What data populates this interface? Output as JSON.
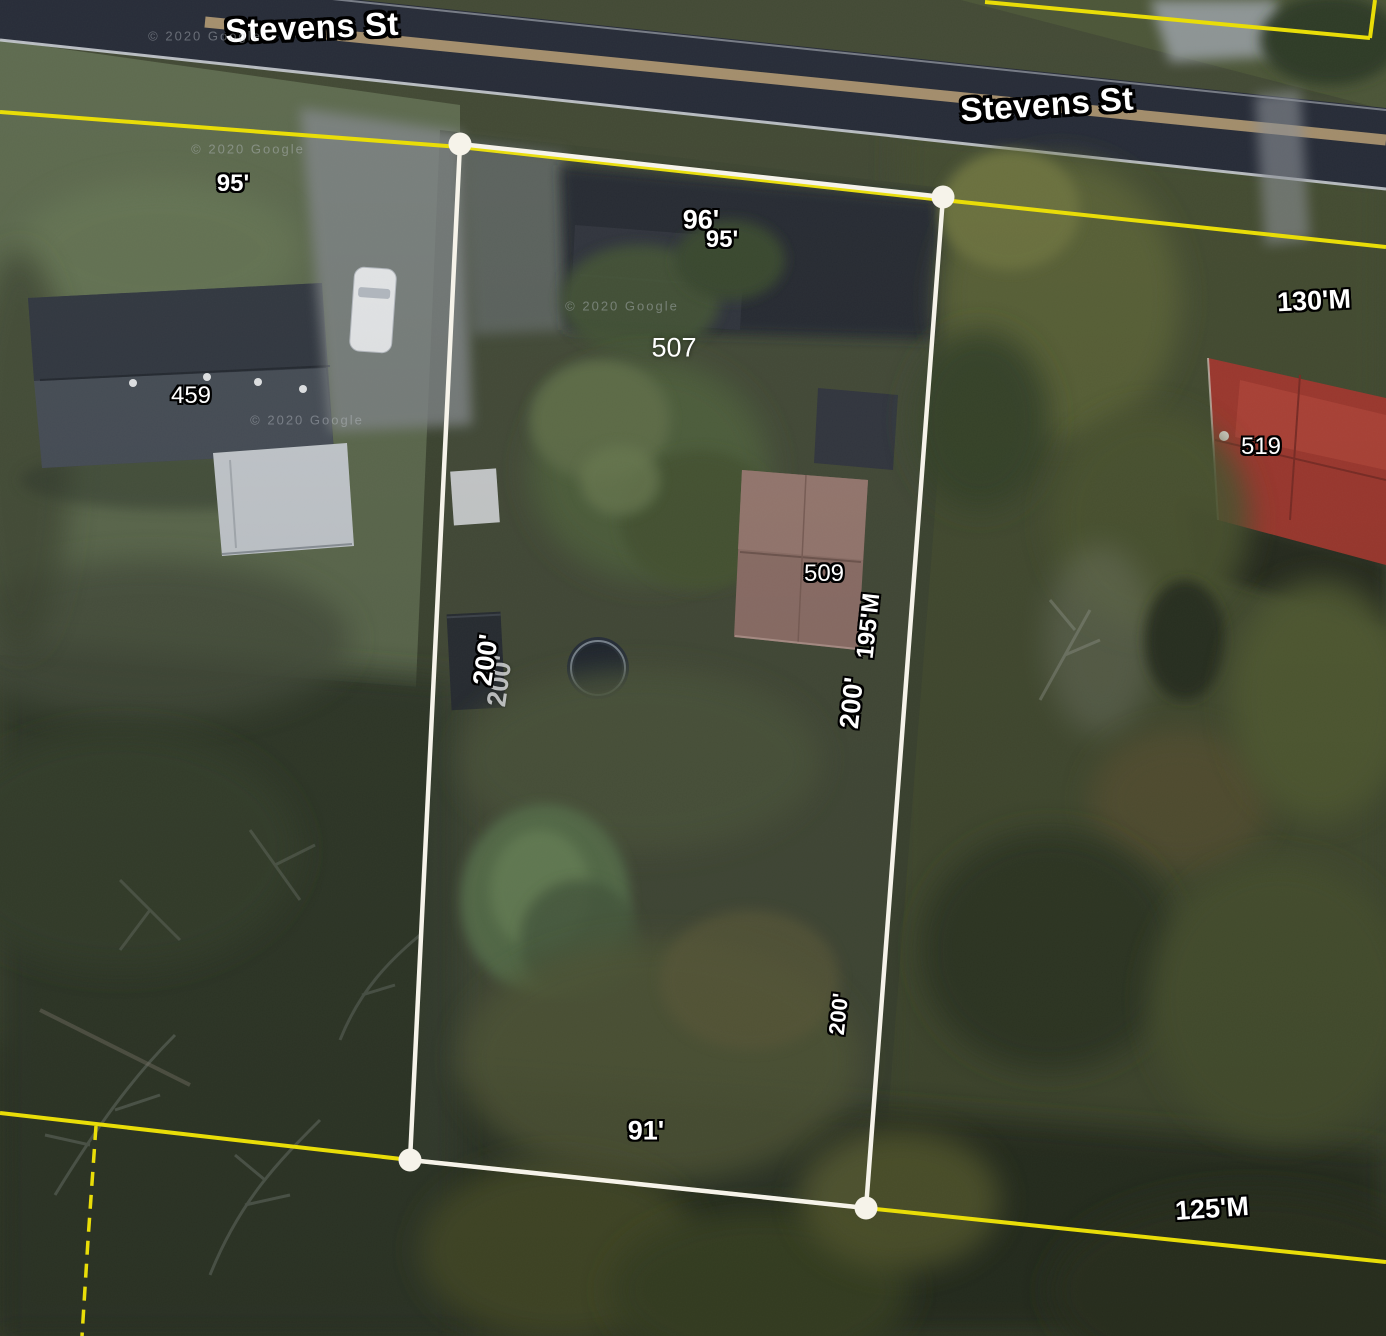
{
  "map": {
    "street_name": "Stevens St",
    "attribution": "© 2020 Google",
    "house_numbers": [
      "459",
      "507",
      "509",
      "519"
    ],
    "measurements": [
      "95'",
      "96'",
      "95'",
      "130'M",
      "195'M",
      "200'",
      "200'",
      "200'",
      "91'",
      "125'M"
    ]
  },
  "colors": {
    "parcel_outline": "#f6f3ea",
    "boundary_yellow": "#e9dd08",
    "label_text": "#ffffff",
    "label_outline": "#000000",
    "road_asphalt": "#272c38",
    "red_roof": "#a23a30",
    "mauve_roof": "#8e6e65"
  },
  "labels": [
    {
      "text": "Stevens St",
      "x": 312,
      "y": 27,
      "rot": -2.5,
      "type": "street",
      "name": "street-name-label"
    },
    {
      "text": "Stevens St",
      "x": 1047,
      "y": 104,
      "rot": -4,
      "type": "street",
      "name": "street-name-label"
    },
    {
      "text": "95'",
      "x": 233,
      "y": 184,
      "rot": 0,
      "type": "measure",
      "name": "measurement-label"
    },
    {
      "text": "96'",
      "x": 701,
      "y": 220,
      "rot": 0,
      "type": "measure-lg",
      "name": "measurement-label"
    },
    {
      "text": "95'",
      "x": 722,
      "y": 240,
      "rot": 0,
      "type": "measure",
      "name": "measurement-label"
    },
    {
      "text": "507",
      "x": 674,
      "y": 348,
      "rot": 0,
      "type": "address-plain",
      "name": "house-number-label"
    },
    {
      "text": "459",
      "x": 191,
      "y": 396,
      "rot": 0,
      "type": "address",
      "name": "house-number-label"
    },
    {
      "text": "130'M",
      "x": 1314,
      "y": 301,
      "rot": -3,
      "type": "measure-lg",
      "name": "measurement-label"
    },
    {
      "text": "519",
      "x": 1261,
      "y": 447,
      "rot": 0,
      "type": "address",
      "name": "house-number-label"
    },
    {
      "text": "509",
      "x": 824,
      "y": 574,
      "rot": 0,
      "type": "address",
      "name": "house-number-label"
    },
    {
      "text": "195'M",
      "x": 869,
      "y": 626,
      "rot": -84,
      "type": "measure",
      "name": "measurement-label"
    },
    {
      "text": "200'",
      "x": 852,
      "y": 703,
      "rot": -84,
      "type": "measure-lg",
      "name": "measurement-label"
    },
    {
      "text": "200'",
      "x": 500,
      "y": 681,
      "rot": -82,
      "type": "measure-ghost",
      "name": "measurement-label"
    },
    {
      "text": "200'",
      "x": 486,
      "y": 660,
      "rot": -82,
      "type": "measure-lg",
      "name": "measurement-label"
    },
    {
      "text": "200'",
      "x": 839,
      "y": 1014,
      "rot": -84,
      "type": "measure-sm",
      "name": "measurement-label"
    },
    {
      "text": "91'",
      "x": 646,
      "y": 1131,
      "rot": 0,
      "type": "measure-lg",
      "name": "measurement-label"
    },
    {
      "text": "125'M",
      "x": 1212,
      "y": 1209,
      "rot": -4,
      "type": "measure-lg",
      "name": "measurement-label"
    },
    {
      "text": "© 2020 Google",
      "x": 205,
      "y": 36,
      "rot": 0,
      "type": "watermark",
      "name": "google-attribution-watermark"
    },
    {
      "text": "© 2020 Google",
      "x": 248,
      "y": 149,
      "rot": 0,
      "type": "watermark",
      "name": "google-attribution-watermark"
    },
    {
      "text": "© 2020 Google",
      "x": 622,
      "y": 306,
      "rot": 0,
      "type": "watermark",
      "name": "google-attribution-watermark"
    },
    {
      "text": "© 2020 Google",
      "x": 307,
      "y": 420,
      "rot": 0,
      "type": "watermark",
      "name": "google-attribution-watermark"
    }
  ]
}
